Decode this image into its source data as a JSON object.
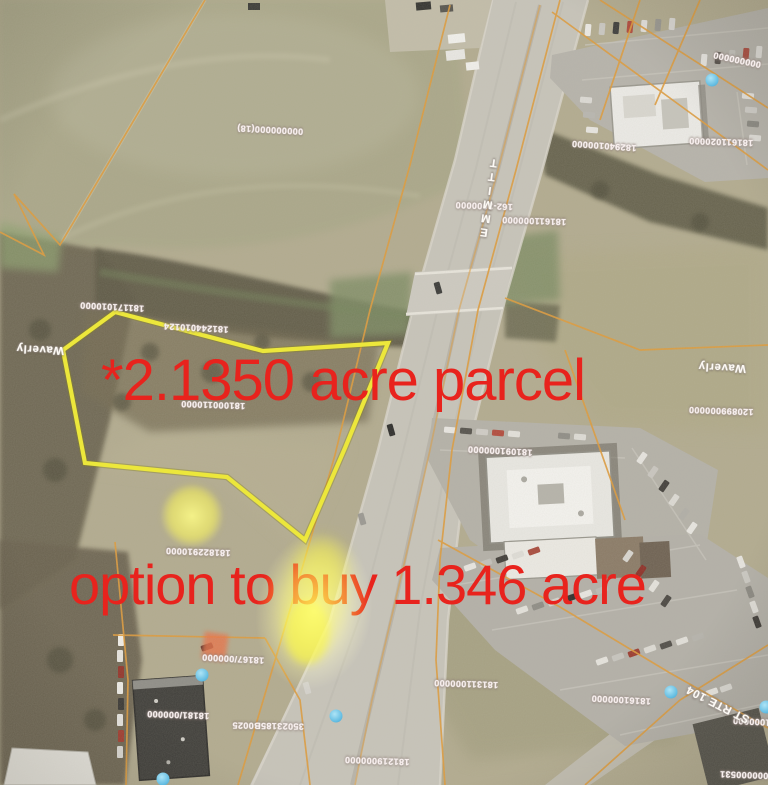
{
  "annotations": {
    "parcel_text": "*2.1350 acre parcel",
    "option_text": "option to buy 1.346 acre"
  },
  "street_labels": [
    {
      "t": "EMMITT",
      "x": 489,
      "y": 196,
      "r": 188,
      "vertical": true
    },
    {
      "t": "Waverly",
      "x": 40,
      "y": 349,
      "r": 183,
      "vertical": false
    },
    {
      "t": "Waverly",
      "x": 722,
      "y": 367,
      "r": 183,
      "vertical": false
    },
    {
      "t": "ST RTE 104",
      "x": 718,
      "y": 704,
      "r": 207,
      "vertical": false
    }
  ],
  "parcel_labels": [
    {
      "t": "000000000(18)",
      "x": 270,
      "y": 130,
      "r": 183
    },
    {
      "t": "162-2000000",
      "x": 484,
      "y": 206,
      "r": 182
    },
    {
      "t": "181611000000",
      "x": 534,
      "y": 221,
      "r": 182
    },
    {
      "t": "182940100000",
      "x": 604,
      "y": 146,
      "r": 184
    },
    {
      "t": "181611020000",
      "x": 721,
      "y": 142,
      "r": 182
    },
    {
      "t": "000000000",
      "x": 737,
      "y": 60,
      "r": 192
    },
    {
      "t": "181171010000",
      "x": 112,
      "y": 307,
      "r": 183
    },
    {
      "t": "181244010124",
      "x": 196,
      "y": 328,
      "r": 183
    },
    {
      "t": "181000110000",
      "x": 213,
      "y": 405,
      "r": 182
    },
    {
      "t": "120899000000",
      "x": 721,
      "y": 411,
      "r": 182
    },
    {
      "t": "181091000000",
      "x": 500,
      "y": 451,
      "r": 183
    },
    {
      "t": "181822910000",
      "x": 198,
      "y": 552,
      "r": 182
    },
    {
      "t": "18167/000000",
      "x": 233,
      "y": 659,
      "r": 183
    },
    {
      "t": "18181/000000",
      "x": 178,
      "y": 715,
      "r": 182
    },
    {
      "t": "35023185B0025",
      "x": 268,
      "y": 726,
      "r": 181
    },
    {
      "t": "181219000000",
      "x": 377,
      "y": 761,
      "r": 182
    },
    {
      "t": "181311000000",
      "x": 466,
      "y": 684,
      "r": 182
    },
    {
      "t": "18161000000",
      "x": 621,
      "y": 700,
      "r": 183
    },
    {
      "t": "181000000",
      "x": 757,
      "y": 722,
      "r": 183
    },
    {
      "t": "000000531",
      "x": 744,
      "y": 775,
      "r": 182
    }
  ],
  "map_markers": {
    "blue_dots": [
      {
        "x": 712,
        "y": 80
      },
      {
        "x": 202,
        "y": 675
      },
      {
        "x": 336,
        "y": 716
      },
      {
        "x": 163,
        "y": 779
      },
      {
        "x": 671,
        "y": 692
      },
      {
        "x": 766,
        "y": 707
      }
    ]
  },
  "colors": {
    "annotation_red": "#e8231d",
    "parcel_outline_yellow": "#ece73b",
    "cadastral_orange": "#de9b3c",
    "marker_blue": "#64bde2",
    "highlight_yellow": "#f2eb3a"
  }
}
